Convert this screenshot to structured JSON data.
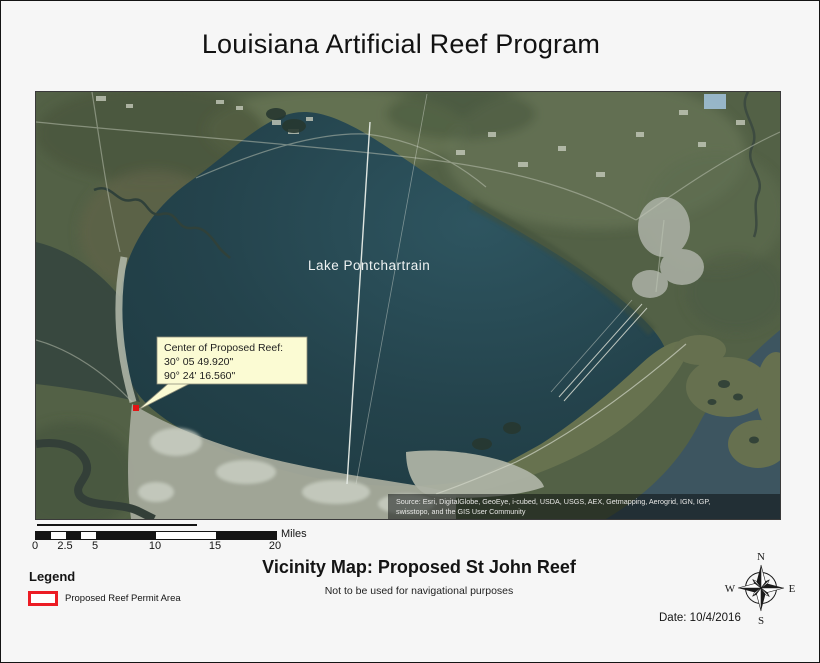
{
  "page": {
    "title": "Louisiana Artificial Reef Program"
  },
  "map": {
    "lake_label": "Lake Pontchartrain",
    "callout": {
      "title": "Center of Proposed Reef:",
      "lat": "30° 05 49.920\"",
      "lon": "90° 24' 16.560\""
    },
    "attribution": {
      "line1": "Source: Esri, DigitalGlobe, GeoEye, i-cubed, USDA, USGS, AEX, Getmapping, Aerogrid, IGN, IGP,",
      "line2": "swisstopo, and the GIS User Community"
    },
    "colors": {
      "lake": "#24434c",
      "land": "#536146",
      "urban": "#a4a99b",
      "reef_marker": "#e31414",
      "callout_fill": "#fbfbd3"
    }
  },
  "scalebar": {
    "labels": [
      "0",
      "2.5",
      "5",
      "10",
      "15",
      "20"
    ],
    "unit": "Miles"
  },
  "legend": {
    "title": "Legend",
    "items": [
      {
        "label": "Proposed Reef Permit Area",
        "swatch_color": "#ec1c24"
      }
    ]
  },
  "footer": {
    "map_title": "Vicinity Map: Proposed St John Reef",
    "disclaimer": "Not to be used for navigational purposes",
    "date_label": "Date: 10/4/2016"
  },
  "compass": {
    "n": "N",
    "e": "E",
    "s": "S",
    "w": "W"
  }
}
